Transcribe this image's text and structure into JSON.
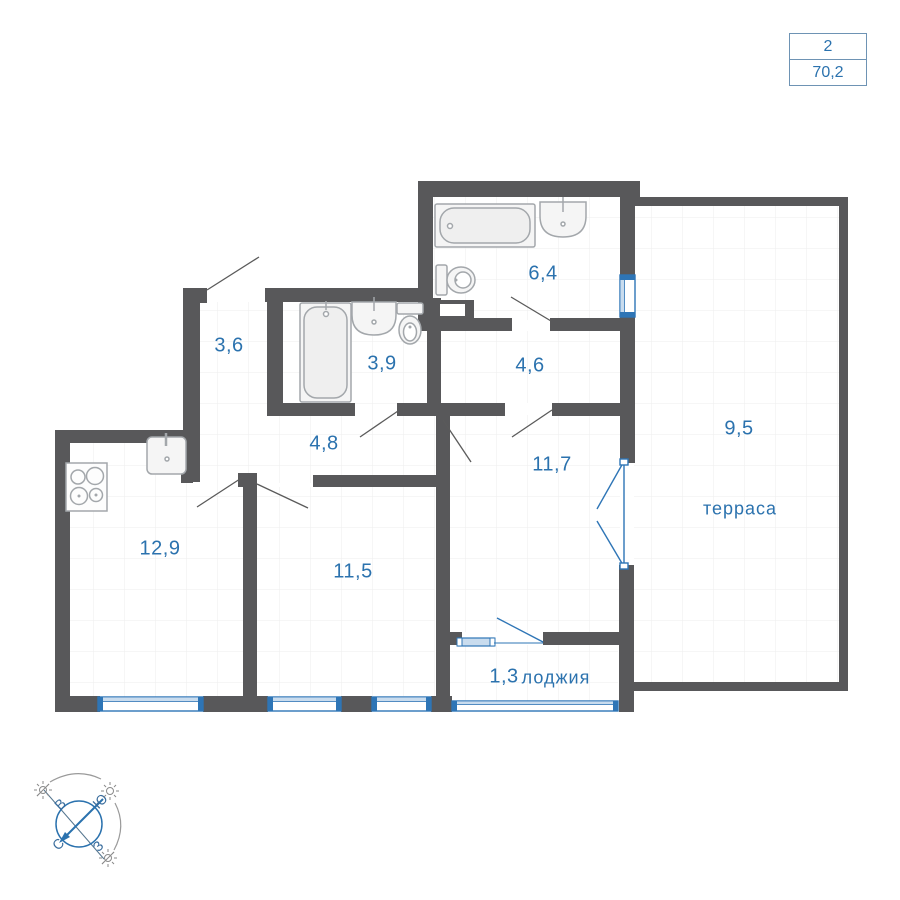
{
  "summary": {
    "rooms_count": "2",
    "total_area": "70,2"
  },
  "rooms": [
    {
      "id": "hallway-3-6",
      "area": "3,6"
    },
    {
      "id": "bathroom-3-9",
      "area": "3,9"
    },
    {
      "id": "bathroom-6-4",
      "area": "6,4"
    },
    {
      "id": "hall-4-6",
      "area": "4,6"
    },
    {
      "id": "corridor-4-8",
      "area": "4,8"
    },
    {
      "id": "room-11-7",
      "area": "11,7"
    },
    {
      "id": "kitchen-12-9",
      "area": "12,9"
    },
    {
      "id": "room-11-5",
      "area": "11,5"
    },
    {
      "id": "loggia",
      "area": "1,3",
      "name": "лоджия"
    },
    {
      "id": "terrace",
      "area": "9,5",
      "name": "терраса"
    }
  ],
  "compass": {
    "north": "С",
    "south": "Ю",
    "east": "В",
    "west": "З"
  },
  "colors": {
    "accent_blue": "#2b72ae",
    "wall_gray": "#58585a",
    "window_blue": "#2e75b6",
    "window_fill": "#c9dcee",
    "grid_line": "#ededed",
    "fixture_stroke": "#a3a7ab",
    "fixture_fill": "#f5f5f5"
  }
}
